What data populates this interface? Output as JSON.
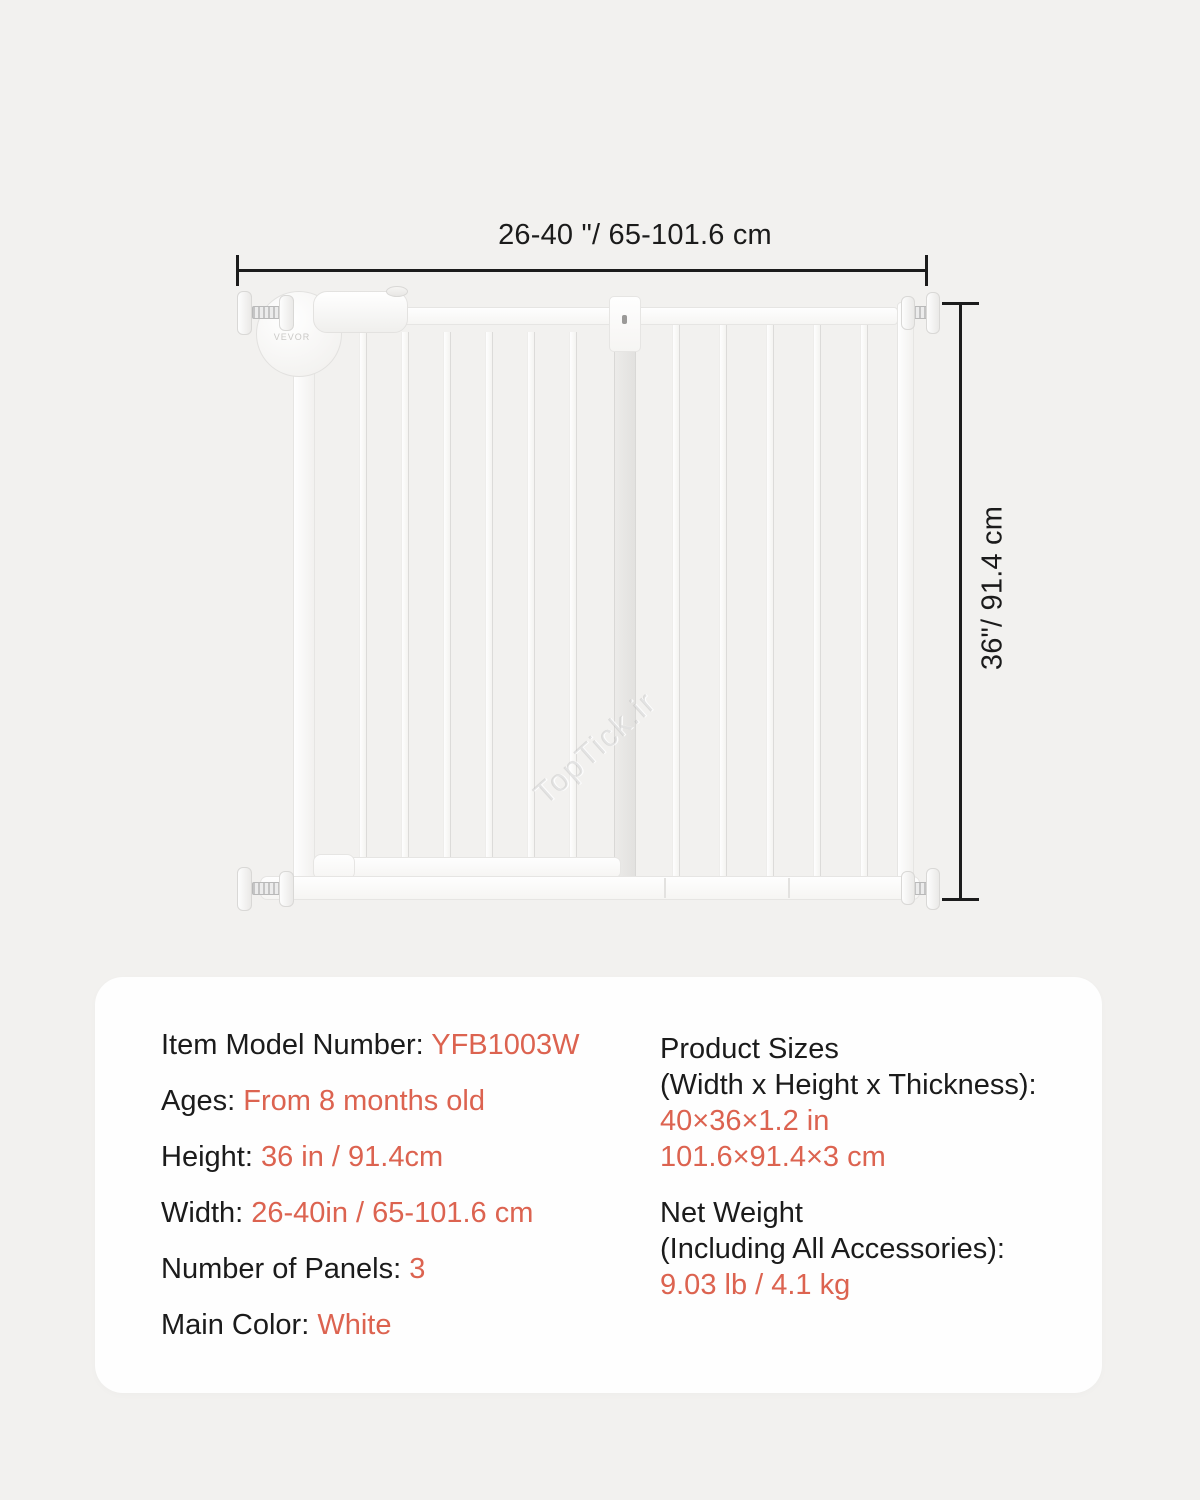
{
  "page": {
    "background": "#f2f1ef",
    "accent_color": "#dc6350",
    "text_color": "#1b1b1b"
  },
  "dimensions": {
    "width_label": "26-40 \"/ 65-101.6 cm",
    "height_label": "36\"/ 91.4 cm"
  },
  "gate": {
    "brand_logo": "VEVOR"
  },
  "watermark": {
    "text": "TopTick.ir"
  },
  "specs": {
    "left_rows": [
      {
        "label": "Item Model Number:",
        "value": "YFB1003W"
      },
      {
        "label": "Ages:",
        "value": "From 8 months old"
      },
      {
        "label": "Height:",
        "value": "36 in / 91.4cm"
      },
      {
        "label": "Width:",
        "value": "26-40in / 65-101.6 cm"
      },
      {
        "label": "Number of Panels:",
        "value": "3"
      },
      {
        "label": "Main Color:",
        "value": "White"
      }
    ],
    "right_groups": [
      {
        "title_line1": "Product Sizes",
        "title_line2": "(Width x Height x Thickness):",
        "value_line1": "40×36×1.2 in",
        "value_line2": "101.6×91.4×3 cm"
      },
      {
        "title_line1": "Net Weight",
        "title_line2": "(Including All Accessories):",
        "value_line1": "9.03 lb / 4.1 kg"
      }
    ]
  }
}
